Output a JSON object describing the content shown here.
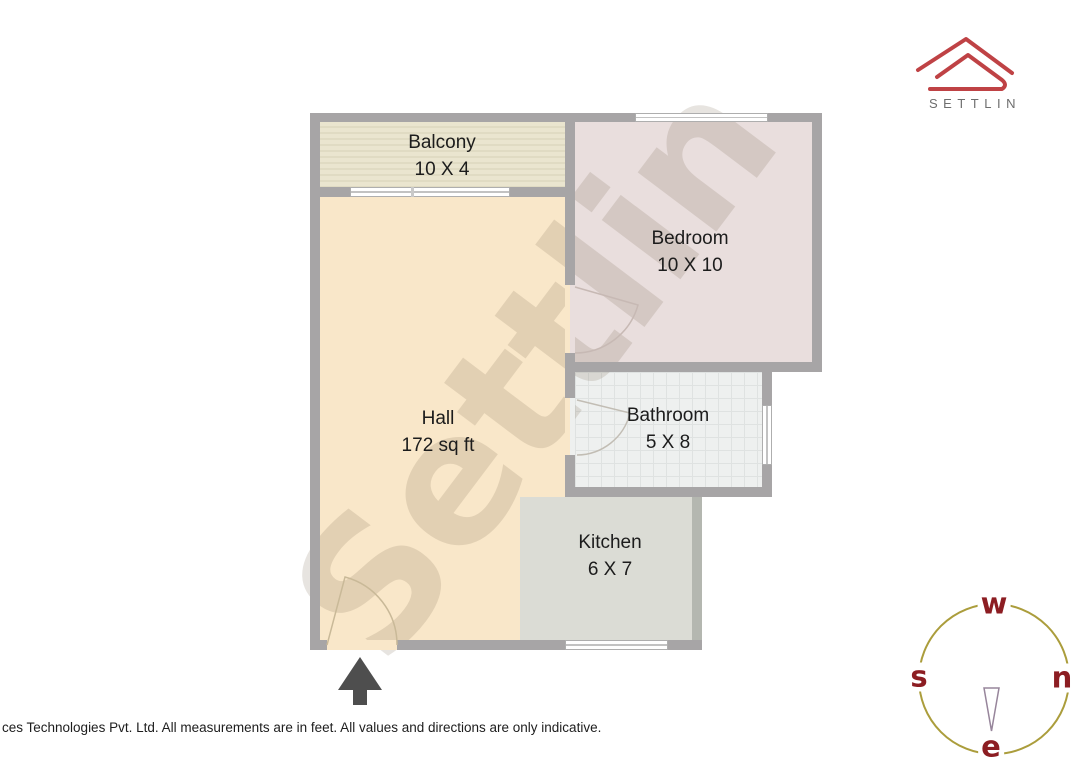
{
  "branding": {
    "logo_text": "SETTLIN"
  },
  "watermark_text": "Settlin",
  "rooms": {
    "balcony": {
      "name": "Balcony",
      "dims": "10 X 4"
    },
    "bedroom": {
      "name": "Bedroom",
      "dims": "10 X 10"
    },
    "hall": {
      "name": "Hall",
      "dims": "172 sq ft"
    },
    "bathroom": {
      "name": "Bathroom",
      "dims": "5 X 8"
    },
    "kitchen": {
      "name": "Kitchen",
      "dims": "6 X 7"
    }
  },
  "compass": {
    "top": "w",
    "left": "s",
    "right": "n",
    "bottom": "e"
  },
  "footer": {
    "disclaimer": "ces Technologies Pvt. Ltd. All measurements are in feet. All values and directions are only indicative."
  },
  "colors": {
    "logo_red": "#bf4245",
    "compass_ring": "#ab9d3c",
    "compass_letters": "#8c1d22",
    "compass_needle": "#97859b",
    "wall_gray": "#a7a5a6",
    "hall_floor": "#f9e7c9",
    "bedroom_floor": "#e9dedd",
    "kitchen_floor": "#dbdcd5",
    "balcony_floor": "#eae5cf",
    "arrow_gray": "#4e4e4e"
  }
}
